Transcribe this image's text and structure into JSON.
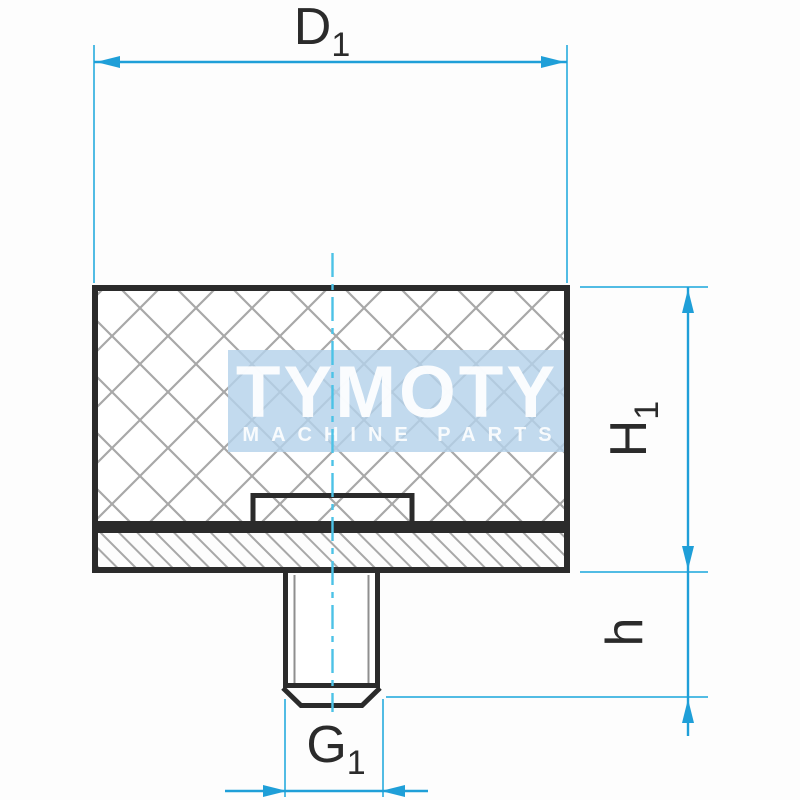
{
  "drawing": {
    "watermark": {
      "brand": "TYMOTY",
      "tagline": "MACHINE PARTS"
    },
    "labels": {
      "d1": {
        "main": "D",
        "sub": "1"
      },
      "h1": {
        "main": "H",
        "sub": "1"
      },
      "h": {
        "main": "h",
        "sub": ""
      },
      "g1": {
        "main": "G",
        "sub": "1"
      }
    }
  },
  "colors": {
    "ink": "#2b2b2b",
    "dim": "#1f9fd8",
    "ext": "#52bce4",
    "center": "#4cc2e6",
    "hatch": "#a8a8a8",
    "thread": "#8f8f8f",
    "wm-band": "#b4d2ea",
    "bg": "#fdfdfd"
  }
}
